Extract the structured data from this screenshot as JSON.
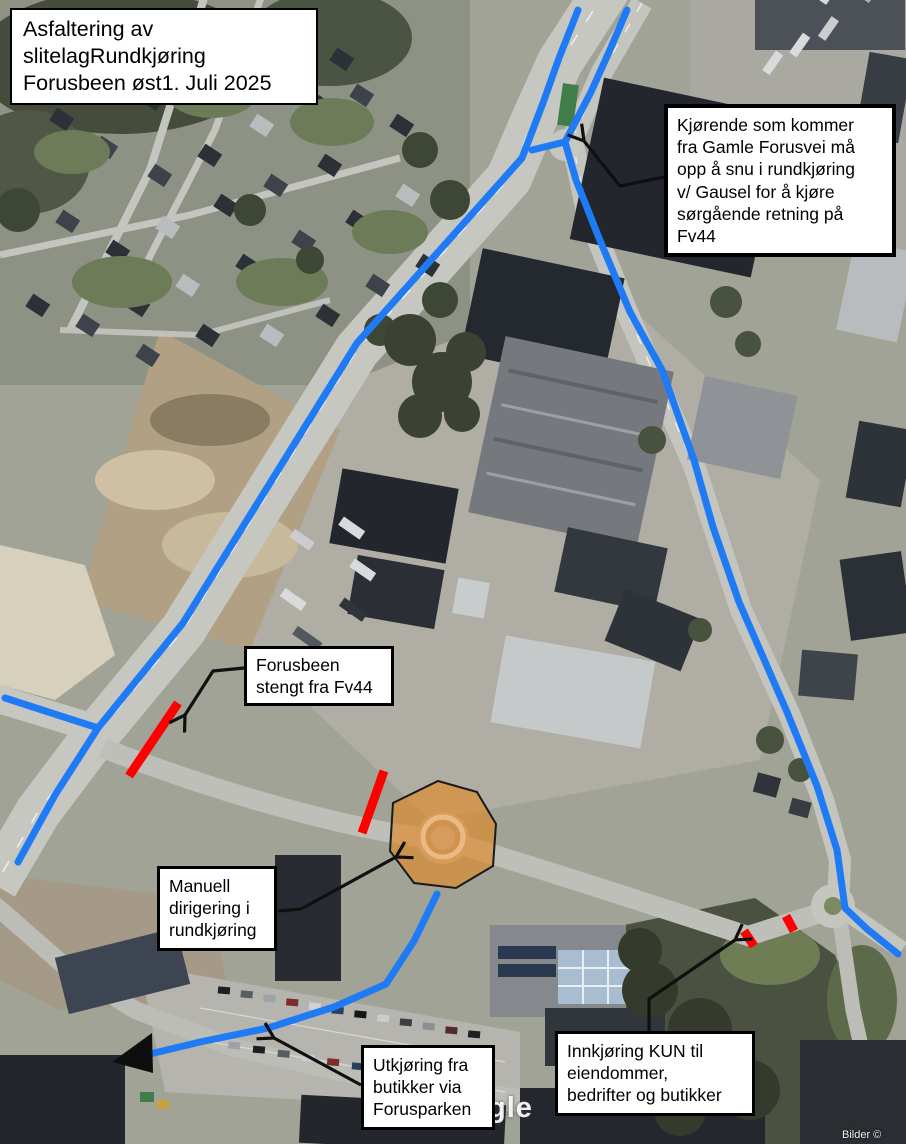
{
  "title_box": {
    "lines": [
      "Asfaltering av",
      "slitelagRundkjøring",
      "Forusbeen øst1. Juli 2025"
    ]
  },
  "callouts": {
    "gausel_turn": {
      "lines": [
        "Kjørende som kommer",
        "fra Gamle Forusvei må",
        "opp å snu i rundkjøring",
        "v/ Gausel for å kjøre",
        "sørgående retning på",
        "Fv44"
      ]
    },
    "forusbeen_closed": {
      "lines": [
        "Forusbeen",
        "stengt fra Fv44"
      ]
    },
    "manual_direction": {
      "lines": [
        "Manuell",
        "dirigering i",
        "rundkjøring"
      ]
    },
    "exit_via_foruspark": {
      "lines": [
        "Utkjøring fra",
        "butikker via",
        "Forusparken"
      ]
    },
    "entry_only": {
      "lines": [
        "Innkjøring KUN til",
        "eiendommer,",
        "bedrifter og butikker"
      ]
    }
  },
  "map": {
    "watermark_visible": "gle",
    "attribution_partial": "Bilder ©",
    "colors": {
      "detour_route": "#1f7bf5",
      "closure": "#fe0000",
      "manual_zone": "#df8a2e"
    }
  }
}
